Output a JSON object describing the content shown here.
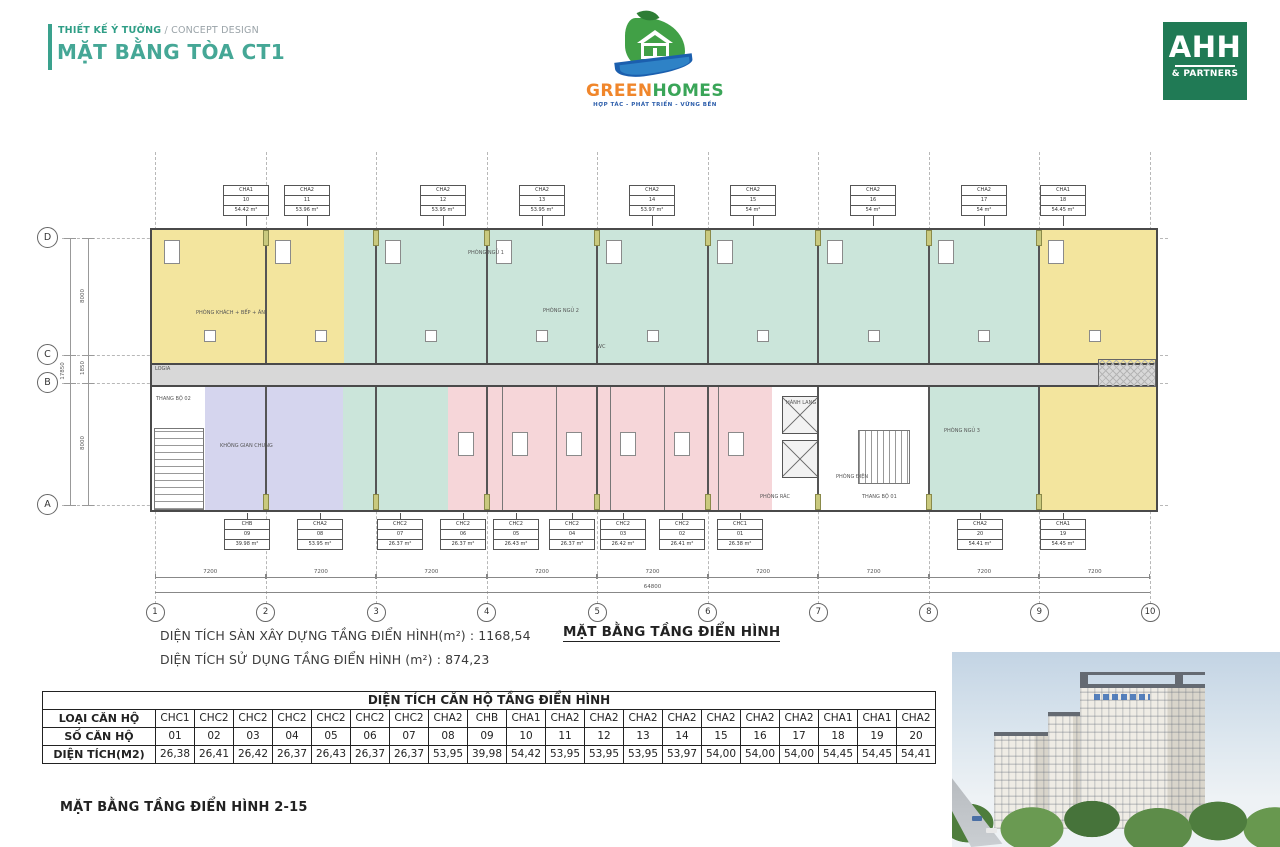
{
  "header": {
    "kicker_primary": "THIẾT KẾ Ý TƯỞNG",
    "kicker_secondary": " / CONCEPT DESIGN",
    "title": "MẶT BẰNG TÒA CT1"
  },
  "brand": {
    "name_part1": "GREEN",
    "name_part2": "HOMES",
    "tagline": "HỢP TÁC - PHÁT TRIỂN - VỮNG BỀN"
  },
  "partner": {
    "name": "AHH",
    "subtitle": "& PARTNERS"
  },
  "plan": {
    "top_units": [
      {
        "type": "CHA1",
        "no": "10",
        "area": "54.42 m²"
      },
      {
        "type": "CHA2",
        "no": "11",
        "area": "53.96 m²"
      },
      {
        "type": "CHA2",
        "no": "12",
        "area": "53.95 m²"
      },
      {
        "type": "CHA2",
        "no": "13",
        "area": "53.95 m²"
      },
      {
        "type": "CHA2",
        "no": "14",
        "area": "53.97 m²"
      },
      {
        "type": "CHA2",
        "no": "15",
        "area": "54 m²"
      },
      {
        "type": "CHA2",
        "no": "16",
        "area": "54 m²"
      },
      {
        "type": "CHA2",
        "no": "17",
        "area": "54 m²"
      },
      {
        "type": "CHA1",
        "no": "18",
        "area": "54.45 m²"
      }
    ],
    "bottom_units": [
      {
        "type": "CHB",
        "no": "09",
        "area": "39.98 m²"
      },
      {
        "type": "CHA2",
        "no": "08",
        "area": "53.95 m²"
      },
      {
        "type": "CHC2",
        "no": "07",
        "area": "26.37 m²"
      },
      {
        "type": "CHC2",
        "no": "06",
        "area": "26.37 m²"
      },
      {
        "type": "CHC2",
        "no": "05",
        "area": "26.43 m²"
      },
      {
        "type": "CHC2",
        "no": "04",
        "area": "26.37 m²"
      },
      {
        "type": "CHC2",
        "no": "03",
        "area": "26.42 m²"
      },
      {
        "type": "CHC2",
        "no": "02",
        "area": "26.41 m²"
      },
      {
        "type": "CHC1",
        "no": "01",
        "area": "26.38 m²"
      },
      {
        "type": "CHA2",
        "no": "20",
        "area": "54.41 m²"
      },
      {
        "type": "CHA1",
        "no": "19",
        "area": "54.45 m²"
      }
    ],
    "row_labels": [
      "D",
      "C",
      "B",
      "A"
    ],
    "col_labels": [
      "1",
      "2",
      "3",
      "4",
      "5",
      "6",
      "7",
      "8",
      "9",
      "10"
    ],
    "bay_dims": [
      "7200",
      "7200",
      "7200",
      "7200",
      "7200",
      "7200",
      "7200",
      "7200",
      "7200"
    ],
    "total_dim": "64800",
    "left_dims": [
      "8000",
      "1850",
      "8000"
    ],
    "left_total_dim": "17850",
    "room_labels": [
      "THANG BỘ 02",
      "KHÔNG GIAN CHUNG",
      "LOGIA",
      "PHÒNG KHÁCH + BẾP + ĂN",
      "PHÒNG NGỦ 1",
      "PHÒNG NGỦ 2",
      "WC",
      "HÀNH LANG",
      "PHÒNG ĐIỆN",
      "THANG BỘ 01",
      "PHÒNG RÁC",
      "PHÒNG NGỦ 3"
    ]
  },
  "notes": {
    "line1": "DIỆN TÍCH SÀN XÂY DỰNG TẦNG ĐIỂN HÌNH(m²) :  1168,54",
    "line2": "DIỆN TÍCH SỬ DỤNG TẦNG ĐIỂN HÌNH (m²) :  874,23",
    "plan_caption": "MẶT BẰNG TẦNG ĐIỂN HÌNH"
  },
  "table": {
    "title": "DIỆN TÍCH CĂN HỘ TẦNG ĐIỂN HÌNH",
    "row_headers": [
      "LOẠI CĂN HỘ",
      "SỐ CĂN HỘ",
      "DIỆN TÍCH(M2)"
    ],
    "types": [
      "CHC1",
      "CHC2",
      "CHC2",
      "CHC2",
      "CHC2",
      "CHC2",
      "CHC2",
      "CHA2",
      "CHB",
      "CHA1",
      "CHA2",
      "CHA2",
      "CHA2",
      "CHA2",
      "CHA2",
      "CHA2",
      "CHA2",
      "CHA1",
      "CHA1",
      "CHA2"
    ],
    "numbers": [
      "01",
      "02",
      "03",
      "04",
      "05",
      "06",
      "07",
      "08",
      "09",
      "10",
      "11",
      "12",
      "13",
      "14",
      "15",
      "16",
      "17",
      "18",
      "19",
      "20"
    ],
    "areas": [
      "26,38",
      "26,41",
      "26,42",
      "26,37",
      "26,43",
      "26,37",
      "26,37",
      "53,95",
      "39,98",
      "54,42",
      "53,95",
      "53,95",
      "53,95",
      "53,97",
      "54,00",
      "54,00",
      "54,00",
      "54,45",
      "54,45",
      "54,41"
    ]
  },
  "footer": {
    "caption": "MẶT BẰNG TẦNG ĐIỂN HÌNH 2-15"
  },
  "colors": {
    "accent_green": "#3aa18d",
    "brand_orange": "#f0862b",
    "brand_green": "#3aa558",
    "brand_blue": "#2a5caa",
    "partner_green": "#207a55",
    "unit_yellow": "#f3e59e",
    "unit_teal": "#cbe5da",
    "unit_pink": "#f6d6d9",
    "unit_lavender": "#d5d5ee",
    "corridor_gray": "#d8d8d8"
  }
}
